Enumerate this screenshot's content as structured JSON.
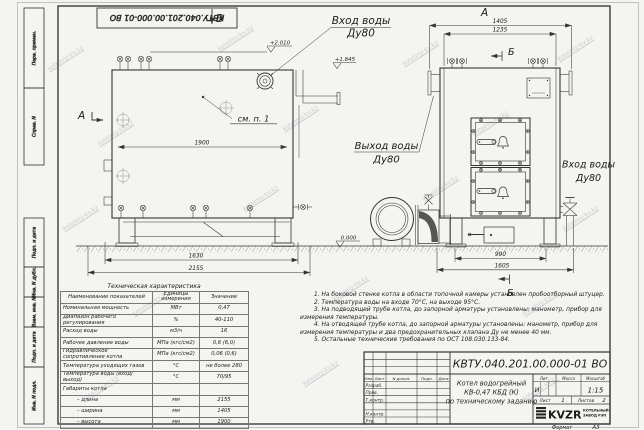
{
  "watermark": {
    "text": "kotelniy-kv.kz"
  },
  "margin_stamps": {
    "items": [
      "Перв. примен.",
      "Справ. N",
      "Подп. и дата",
      "Инв. N дубл.",
      "Взам. инв. N",
      "Подп. и дата",
      "Инв. N подл."
    ]
  },
  "top_stamp": {
    "text": "КВТУ.040.201.00.000-01 ВО"
  },
  "drawing": {
    "views": {
      "b": "В",
      "a_arrow": "А",
      "a": "А",
      "b_upper": "Б",
      "b_lower": "Б"
    },
    "labels": {
      "inlet_top_line1": "Вход воды",
      "inlet_top_line2": "Ду80",
      "outlet_line1": "Выход воды",
      "outlet_line2": "Ду80",
      "inlet_right_line1": "Вход воды",
      "inlet_right_line2": "Ду80",
      "note_ref": "см. п. 1"
    },
    "elevations": {
      "top": "+2.010",
      "pipe": "+1.845",
      "ground": "0.000"
    },
    "dims": {
      "d1900": "1900",
      "d1630": "1630",
      "d2155": "2155",
      "d1405": "1405",
      "d1235": "1235",
      "d990": "990",
      "d1605": "1605"
    }
  },
  "spec": {
    "title": "Техническая характеристика",
    "headers": {
      "name": "Наименование показателей",
      "units": "Единицы измерения",
      "value": "Значение"
    },
    "rows": [
      {
        "name": "Номинальная мощность",
        "units": "МВт",
        "value": "0,47"
      },
      {
        "name": "Диапазон рабочего регулирования",
        "units": "%",
        "value": "40-110"
      },
      {
        "name": "Расход воды",
        "units": "м3/ч",
        "value": "16"
      },
      {
        "name": "Рабочее давление воды",
        "units": "МПа (кгс/см2)",
        "value": "0,6 (6,0)"
      },
      {
        "name": "Гидравлическое сопротивление котла",
        "units": "МПа (кгс/см2)",
        "value": "0,06 (0,6)"
      },
      {
        "name": "Температура уходящих газов",
        "units": "°С",
        "value": "не более 280"
      },
      {
        "name": "Температура воды (вход/выход)",
        "units": "°С",
        "value": "70/95"
      },
      {
        "name": "Габариты котла",
        "units": "",
        "value": ""
      },
      {
        "name": "– длина",
        "units": "мм",
        "value": "2155"
      },
      {
        "name": "– ширина",
        "units": "мм",
        "value": "1405"
      },
      {
        "name": "– высота",
        "units": "мм",
        "value": "1900"
      }
    ]
  },
  "notes": {
    "items": [
      "1. На боковой стенке котла в области топочной камеры установлен пробоотборный штуцер.",
      "2. Температура воды на входе 70°С, на выходе 95°С.",
      "3. На подводящей трубе котла, до запорной арматуры установлены: манометр, прибор для измерения температуры.",
      "4. На отводящей трубе котла, до запорной арматуры установлены: манометр, прибор для измерения температуры и два предохранительных клапана Ду не менее 40 мм.",
      "5. Остальные технические требования по ОСТ 108.030.133-84."
    ]
  },
  "tb": {
    "doc_number": "КВТУ.040.201.00.000-01 ВО",
    "name1": "Котел водогрейный",
    "name2": "КВ-0,47 КБД (К)",
    "name3": "по техническому заданию",
    "lit_h": "Лит.",
    "mass_h": "Масса",
    "scale_h": "Масштаб",
    "lit_v": "И",
    "scale_v": "1:15",
    "sheet_h": "Лист",
    "sheet_v": "1",
    "sheets_h": "Листов",
    "sheets_v": "2",
    "col_izm": "Изм.",
    "col_list": "Лист",
    "col_doc": "N докум.",
    "col_sign": "Подп.",
    "col_date": "Дата",
    "row_dev": "Разраб.",
    "row_check": "Пров.",
    "row_tcontr": "Т.контр.",
    "row_ncontr": "Н.контр.",
    "row_app": "Утв.",
    "logo": "KVZR",
    "logo_sub1": "КОТЕЛЬНЫЙ",
    "logo_sub2": "ЗАВОД РЭП",
    "format_label": "Формат",
    "format_value": "А3"
  }
}
